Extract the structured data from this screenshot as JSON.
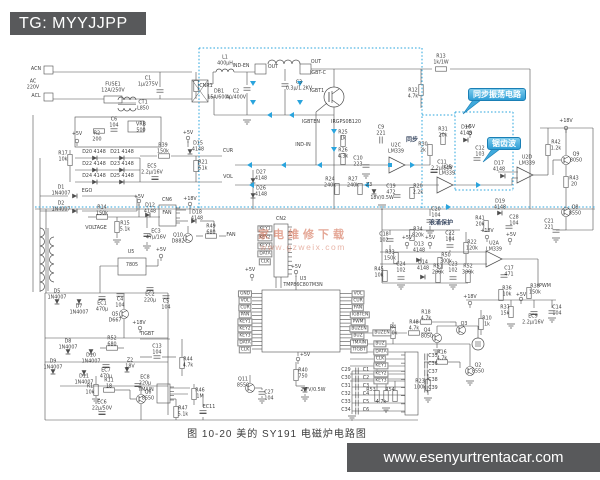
{
  "badge": {
    "text": "TG: MYYJJPP"
  },
  "footer": {
    "url": "www.esenyurtrentacar.com"
  },
  "caption": {
    "text": "图 10-20  美的 SY191 电磁炉电路图"
  },
  "watermark": {
    "line1": "家电维修下载",
    "line2": "www.gzweix.com"
  },
  "callouts": {
    "sync": "同步振荡电路",
    "sawtooth": "锯齿波"
  },
  "colors": {
    "line": "#4d4d4d",
    "highlight": "#2aa4dd",
    "badge_bg": "#58595b",
    "watermark": "#c05a3f",
    "paper": "#ffffff"
  },
  "labels": [
    {
      "t": "ACN",
      "x": 36,
      "y": 70
    },
    {
      "t": "AC\n220V",
      "x": 33,
      "y": 85
    },
    {
      "t": "ACL",
      "x": 36,
      "y": 97
    },
    {
      "t": "FUSE1\n12A/250V",
      "x": 113,
      "y": 88
    },
    {
      "t": "C1\n1μ/275V",
      "x": 148,
      "y": 82
    },
    {
      "t": "CNR1",
      "x": 206,
      "y": 87
    },
    {
      "t": "L1\n400μH",
      "x": 225,
      "y": 61
    },
    {
      "t": "DB1\n15A/600V",
      "x": 219,
      "y": 95
    },
    {
      "t": "IND-EN",
      "x": 241,
      "y": 67
    },
    {
      "t": "OUT",
      "x": 273,
      "y": 68
    },
    {
      "t": "OUT",
      "x": 316,
      "y": 63
    },
    {
      "t": "C3\n0.3μ/1.2KV",
      "x": 299,
      "y": 86
    },
    {
      "t": "C2\n4μ/400V",
      "x": 236,
      "y": 95
    },
    {
      "t": "IGBT-C",
      "x": 318,
      "y": 74
    },
    {
      "t": "IGBT1",
      "x": 317,
      "y": 92
    },
    {
      "t": "IRGPS0B120",
      "x": 346,
      "y": 123
    },
    {
      "t": "IGBTEN",
      "x": 311,
      "y": 123
    },
    {
      "t": "IND-IN",
      "x": 303,
      "y": 146
    },
    {
      "t": "CT1\nL850",
      "x": 143,
      "y": 106
    },
    {
      "t": "C6\n104",
      "x": 114,
      "y": 123
    },
    {
      "t": "R2\n200",
      "x": 97,
      "y": 137
    },
    {
      "t": "VRB\n500",
      "x": 141,
      "y": 128
    },
    {
      "t": "+5V",
      "x": 77,
      "y": 135
    },
    {
      "t": "R13\n1k/1W",
      "x": 441,
      "y": 60
    },
    {
      "t": "R12\n4.7k",
      "x": 413,
      "y": 94
    },
    {
      "t": "C9\n221",
      "x": 381,
      "y": 131
    },
    {
      "t": "R25\n1k",
      "x": 343,
      "y": 136
    },
    {
      "t": "R26\n4.3k",
      "x": 343,
      "y": 154
    },
    {
      "t": "C10\n223",
      "x": 358,
      "y": 162
    },
    {
      "t": "U2C\nLM339",
      "x": 396,
      "y": 149
    },
    {
      "t": "同步",
      "x": 412,
      "y": 141,
      "c": "cn"
    },
    {
      "t": "R31\n20k",
      "x": 443,
      "y": 133
    },
    {
      "t": "D16\n4148",
      "x": 466,
      "y": 131
    },
    {
      "t": "R30\n2k",
      "x": 423,
      "y": 148
    },
    {
      "t": "C11\n2.2μ/50V",
      "x": 442,
      "y": 166
    },
    {
      "t": "+5V",
      "x": 470,
      "y": 128
    },
    {
      "t": "C12\n103",
      "x": 480,
      "y": 152
    },
    {
      "t": "R24\n240k",
      "x": 330,
      "y": 183
    },
    {
      "t": "R27\n240k",
      "x": 353,
      "y": 183
    },
    {
      "t": "Z3",
      "x": 369,
      "y": 186
    },
    {
      "t": "18V/0.5W",
      "x": 382,
      "y": 199
    },
    {
      "t": "C19\n472",
      "x": 391,
      "y": 190
    },
    {
      "t": "R20\n2.2k",
      "x": 418,
      "y": 190
    },
    {
      "t": "U2B\nLM339",
      "x": 447,
      "y": 171
    },
    {
      "t": "U2D\nLM339",
      "x": 527,
      "y": 161
    },
    {
      "t": "D17\n4148",
      "x": 499,
      "y": 167
    },
    {
      "t": "R42\n1.2k",
      "x": 556,
      "y": 146
    },
    {
      "t": "Q9\n8050",
      "x": 576,
      "y": 158
    },
    {
      "t": "R43\n20",
      "x": 574,
      "y": 182
    },
    {
      "t": "Q8\n8550",
      "x": 575,
      "y": 211
    },
    {
      "t": "C21\n221",
      "x": 549,
      "y": 225
    },
    {
      "t": "D19\n4148",
      "x": 500,
      "y": 205
    },
    {
      "t": "C28\n104",
      "x": 514,
      "y": 221
    },
    {
      "t": "R41\n20k",
      "x": 480,
      "y": 222
    },
    {
      "t": "+18V",
      "x": 566,
      "y": 122
    },
    {
      "t": "+18V",
      "x": 190,
      "y": 200
    },
    {
      "t": "D27\n4148",
      "x": 261,
      "y": 176
    },
    {
      "t": "D26\n4148",
      "x": 261,
      "y": 192
    },
    {
      "t": "C20\n104",
      "x": 436,
      "y": 213
    },
    {
      "t": "浪涌保护",
      "x": 441,
      "y": 224,
      "c": "cn"
    },
    {
      "t": "C18\n102",
      "x": 384,
      "y": 238
    },
    {
      "t": "R34\n820k",
      "x": 418,
      "y": 233
    },
    {
      "t": "R33\n150k",
      "x": 390,
      "y": 256
    },
    {
      "t": "D13\n4148",
      "x": 419,
      "y": 248
    },
    {
      "t": "R50\n300k",
      "x": 446,
      "y": 259
    },
    {
      "t": "C22\n104",
      "x": 450,
      "y": 237
    },
    {
      "t": "R22\n120k",
      "x": 472,
      "y": 246
    },
    {
      "t": "R45\n10k",
      "x": 379,
      "y": 273
    },
    {
      "t": "C24\n102",
      "x": 401,
      "y": 268
    },
    {
      "t": "D14\n4148",
      "x": 423,
      "y": 266
    },
    {
      "t": "R51\n200k",
      "x": 438,
      "y": 270
    },
    {
      "t": "C23\n102",
      "x": 453,
      "y": 268
    },
    {
      "t": "R52\n300k",
      "x": 468,
      "y": 270
    },
    {
      "t": "U2A\nLM339",
      "x": 494,
      "y": 247
    },
    {
      "t": "C17\n471",
      "x": 509,
      "y": 272
    },
    {
      "t": "+5V",
      "x": 407,
      "y": 239
    },
    {
      "t": "+5V",
      "x": 430,
      "y": 239
    },
    {
      "t": "+18V",
      "x": 487,
      "y": 232
    },
    {
      "t": "+5V",
      "x": 511,
      "y": 236
    },
    {
      "t": "R36\n10k",
      "x": 507,
      "y": 292
    },
    {
      "t": "R38\n150k",
      "x": 535,
      "y": 290
    },
    {
      "t": "R37\n15k",
      "x": 505,
      "y": 311
    },
    {
      "t": "EC9\n2.2μ/16V",
      "x": 533,
      "y": 320
    },
    {
      "t": "C14\n104",
      "x": 557,
      "y": 311
    },
    {
      "t": "+5V",
      "x": 521,
      "y": 296
    },
    {
      "t": "+18V",
      "x": 470,
      "y": 298
    },
    {
      "t": "R10\n1k",
      "x": 487,
      "y": 322
    },
    {
      "t": "R18\n4.7k",
      "x": 426,
      "y": 316
    },
    {
      "t": "Q3",
      "x": 464,
      "y": 325
    },
    {
      "t": "R4\n10k",
      "x": 393,
      "y": 331
    },
    {
      "t": "PWM",
      "x": 545,
      "y": 287
    },
    {
      "t": "R17\n10k",
      "x": 63,
      "y": 157
    },
    {
      "t": "D20 4148",
      "x": 94,
      "y": 153
    },
    {
      "t": "D21 4148",
      "x": 122,
      "y": 153
    },
    {
      "t": "D22 4148",
      "x": 94,
      "y": 165
    },
    {
      "t": "D23 4148",
      "x": 122,
      "y": 165
    },
    {
      "t": "D24 4148",
      "x": 94,
      "y": 177
    },
    {
      "t": "D25 4148",
      "x": 122,
      "y": 177
    },
    {
      "t": "R39\n150k",
      "x": 163,
      "y": 149
    },
    {
      "t": "D15\n4148",
      "x": 198,
      "y": 147
    },
    {
      "t": "+5V",
      "x": 188,
      "y": 134
    },
    {
      "t": "R21\n51k",
      "x": 203,
      "y": 166
    },
    {
      "t": "CUR",
      "x": 228,
      "y": 152
    },
    {
      "t": "VOL",
      "x": 228,
      "y": 178
    },
    {
      "t": "EC5\n2.2μ/16V",
      "x": 152,
      "y": 170
    },
    {
      "t": "EGO",
      "x": 87,
      "y": 192
    },
    {
      "t": "D1\n1N4007",
      "x": 61,
      "y": 191
    },
    {
      "t": "D2\n1N4007",
      "x": 61,
      "y": 207
    },
    {
      "t": "R14\n150k",
      "x": 102,
      "y": 211
    },
    {
      "t": "VOLTAGE",
      "x": 96,
      "y": 229
    },
    {
      "t": "R15\n5.1k",
      "x": 125,
      "y": 227
    },
    {
      "t": "D12\n4148",
      "x": 150,
      "y": 209
    },
    {
      "t": "EC3\n47μ/16V",
      "x": 156,
      "y": 235
    },
    {
      "t": "+5V",
      "x": 139,
      "y": 198
    },
    {
      "t": "CN6",
      "x": 167,
      "y": 201
    },
    {
      "t": "FAN",
      "x": 167,
      "y": 214
    },
    {
      "t": "D18\n4148",
      "x": 197,
      "y": 216
    },
    {
      "t": "Q10\nD882",
      "x": 178,
      "y": 239
    },
    {
      "t": "R49\n680",
      "x": 211,
      "y": 230
    },
    {
      "t": "FAN",
      "x": 231,
      "y": 236
    },
    {
      "t": "D5\n1N4007",
      "x": 57,
      "y": 295
    },
    {
      "t": "D7\n1N4007",
      "x": 79,
      "y": 310
    },
    {
      "t": "EC1\n470μ",
      "x": 102,
      "y": 307
    },
    {
      "t": "C4\n104",
      "x": 120,
      "y": 303
    },
    {
      "t": "EC2\n220μ",
      "x": 150,
      "y": 298
    },
    {
      "t": "C5\n104",
      "x": 166,
      "y": 305
    },
    {
      "t": "Q5\nD667",
      "x": 115,
      "y": 318
    },
    {
      "t": "+18V",
      "x": 139,
      "y": 324
    },
    {
      "t": "R52\n680",
      "x": 112,
      "y": 342
    },
    {
      "t": "D8\n1N4007",
      "x": 68,
      "y": 345
    },
    {
      "t": "D10\n1N4007",
      "x": 91,
      "y": 359
    },
    {
      "t": "D9\n1N4007",
      "x": 53,
      "y": 365
    },
    {
      "t": "D11\n1N4007",
      "x": 84,
      "y": 380
    },
    {
      "t": "EC7\n470μ",
      "x": 106,
      "y": 374
    },
    {
      "t": "Z2\n18V",
      "x": 130,
      "y": 364
    },
    {
      "t": "EC8\n220μ",
      "x": 145,
      "y": 381
    },
    {
      "t": "R1\n10k",
      "x": 90,
      "y": 390
    },
    {
      "t": "R11\n18",
      "x": 109,
      "y": 384
    },
    {
      "t": "Q6\n8550",
      "x": 148,
      "y": 396
    },
    {
      "t": "EC6\n22μ/50V",
      "x": 102,
      "y": 406
    },
    {
      "t": "C13\n104",
      "x": 157,
      "y": 350
    },
    {
      "t": "TIGBT",
      "x": 147,
      "y": 335
    },
    {
      "t": "R44\n4.7k",
      "x": 188,
      "y": 363
    },
    {
      "t": "TMAIN",
      "x": 146,
      "y": 391
    },
    {
      "t": "R47\n5.1k",
      "x": 183,
      "y": 412
    },
    {
      "t": "R46\n1M",
      "x": 200,
      "y": 394
    },
    {
      "t": "EC11",
      "x": 209,
      "y": 408
    },
    {
      "t": "U5",
      "x": 131,
      "y": 253
    },
    {
      "t": "7805",
      "x": 132,
      "y": 266
    },
    {
      "t": "+5V",
      "x": 161,
      "y": 251
    },
    {
      "t": "U3",
      "x": 303,
      "y": 280
    },
    {
      "t": "TMP86C807M3N",
      "x": 303,
      "y": 286
    },
    {
      "t": "+5V",
      "x": 296,
      "y": 268
    },
    {
      "t": "CN2",
      "x": 281,
      "y": 220
    },
    {
      "t": "KEY1",
      "x": 265,
      "y": 229,
      "c": "nb"
    },
    {
      "t": "KEY2",
      "x": 265,
      "y": 238,
      "c": "nb"
    },
    {
      "t": "KEY3",
      "x": 265,
      "y": 246,
      "c": "nb"
    },
    {
      "t": "DATA",
      "x": 265,
      "y": 254,
      "c": "nb"
    },
    {
      "t": "CLK",
      "x": 265,
      "y": 262,
      "c": "nb"
    },
    {
      "t": "+5V",
      "x": 250,
      "y": 271
    },
    {
      "t": "GND",
      "x": 245,
      "y": 294,
      "c": "nb"
    },
    {
      "t": "VOL",
      "x": 245,
      "y": 301,
      "c": "nb"
    },
    {
      "t": "CUR",
      "x": 245,
      "y": 308,
      "c": "nb"
    },
    {
      "t": "PAN",
      "x": 245,
      "y": 315,
      "c": "nb"
    },
    {
      "t": "KEY1",
      "x": 245,
      "y": 322,
      "c": "nb"
    },
    {
      "t": "KEY2",
      "x": 245,
      "y": 329,
      "c": "nb"
    },
    {
      "t": "KEY3",
      "x": 245,
      "y": 336,
      "c": "nb"
    },
    {
      "t": "DATA",
      "x": 245,
      "y": 343,
      "c": "nb"
    },
    {
      "t": "CLK",
      "x": 245,
      "y": 350,
      "c": "nb"
    },
    {
      "t": "VOL",
      "x": 358,
      "y": 294,
      "c": "nb"
    },
    {
      "t": "CUR",
      "x": 358,
      "y": 301,
      "c": "nb"
    },
    {
      "t": "FAN",
      "x": 358,
      "y": 308,
      "c": "nb"
    },
    {
      "t": "IGBTEN",
      "x": 360,
      "y": 315,
      "c": "nb"
    },
    {
      "t": "PWM",
      "x": 358,
      "y": 322,
      "c": "nb"
    },
    {
      "t": "BUZEN",
      "x": 359,
      "y": 329,
      "c": "nb"
    },
    {
      "t": "BUZ",
      "x": 358,
      "y": 336,
      "c": "nb"
    },
    {
      "t": "TMAIN",
      "x": 359,
      "y": 343,
      "c": "nb"
    },
    {
      "t": "TIGBT",
      "x": 359,
      "y": 350,
      "c": "nb"
    },
    {
      "t": "Q11\n8550",
      "x": 243,
      "y": 383
    },
    {
      "t": "C27\n104",
      "x": 269,
      "y": 396
    },
    {
      "t": "+5V",
      "x": 305,
      "y": 356
    },
    {
      "t": "R40\n750",
      "x": 303,
      "y": 374
    },
    {
      "t": "2.7V/0.5W",
      "x": 313,
      "y": 391
    },
    {
      "t": "BUZEN",
      "x": 382,
      "y": 333,
      "c": "nb"
    },
    {
      "t": "BUZ",
      "x": 380,
      "y": 344,
      "c": "nb"
    },
    {
      "t": "DATA",
      "x": 381,
      "y": 352,
      "c": "nb"
    },
    {
      "t": "CLK",
      "x": 380,
      "y": 359,
      "c": "nb"
    },
    {
      "t": "KEY1",
      "x": 381,
      "y": 366,
      "c": "nb"
    },
    {
      "t": "KEY2",
      "x": 381,
      "y": 374,
      "c": "nb"
    },
    {
      "t": "KEY3",
      "x": 381,
      "y": 381,
      "c": "nb"
    },
    {
      "t": "R48\n4.7k",
      "x": 414,
      "y": 326
    },
    {
      "t": "Q4\n8050",
      "x": 427,
      "y": 334
    },
    {
      "t": "R16\n4.7k",
      "x": 442,
      "y": 356
    },
    {
      "t": "Q2\n8550",
      "x": 478,
      "y": 369
    },
    {
      "t": "R23\n100k",
      "x": 420,
      "y": 385
    },
    {
      "t": "C29",
      "x": 346,
      "y": 371
    },
    {
      "t": "C30",
      "x": 346,
      "y": 379
    },
    {
      "t": "C31",
      "x": 346,
      "y": 387
    },
    {
      "t": "C32",
      "x": 346,
      "y": 395
    },
    {
      "t": "C33",
      "x": 346,
      "y": 403
    },
    {
      "t": "C34",
      "x": 346,
      "y": 411
    },
    {
      "t": "C1",
      "x": 366,
      "y": 371
    },
    {
      "t": "C2",
      "x": 366,
      "y": 379
    },
    {
      "t": "C3",
      "x": 366,
      "y": 387
    },
    {
      "t": "C4",
      "x": 366,
      "y": 395
    },
    {
      "t": "C5",
      "x": 366,
      "y": 403
    },
    {
      "t": "C6",
      "x": 366,
      "y": 411
    },
    {
      "t": "C35",
      "x": 433,
      "y": 357
    },
    {
      "t": "C36",
      "x": 433,
      "y": 365
    },
    {
      "t": "C37",
      "x": 433,
      "y": 373
    },
    {
      "t": "C38",
      "x": 433,
      "y": 381
    },
    {
      "t": "C39",
      "x": 433,
      "y": 389
    },
    {
      "t": "R53",
      "x": 371,
      "y": 391
    },
    {
      "t": "R54",
      "x": 390,
      "y": 391
    },
    {
      "t": "4.7k",
      "x": 381,
      "y": 403
    }
  ]
}
